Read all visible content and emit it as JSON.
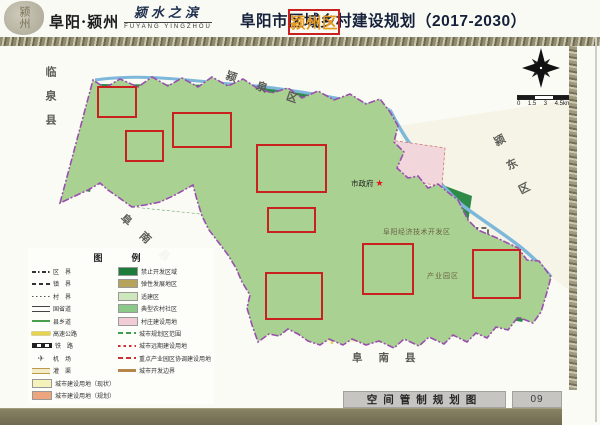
{
  "header": {
    "seal_text": "颍州",
    "brand": "阜阳·颍州",
    "slogan": "颍水之滨",
    "slogan_en": "FUYANG YINGZHOU",
    "title": {
      "prefix": "阜阳市",
      "highlight": "颍州区",
      "suffix": "区域乡村建设规划（2017-2030）"
    }
  },
  "colors": {
    "title_highlight": "#e8991c",
    "highlight_box": "#c92020",
    "district_boundary": "#9a4fae",
    "prohibited_green": "#1e7c3a",
    "suitable_green": "#a9d292",
    "flexible_olive": "#beab67",
    "village_pink": "#f2ccd6"
  },
  "map": {
    "region_labels": {
      "linquan": {
        "text": "临泉县"
      },
      "yingquan": {
        "text": "颍泉区"
      },
      "yingdong": {
        "text": "颍东区"
      },
      "funan_west": {
        "text": "阜南县"
      },
      "funan_south": {
        "text": "阜南县"
      }
    },
    "poi_labels": {
      "city_hall": {
        "text": "市政府",
        "marker": "★"
      },
      "dev_zone": {
        "text": "阜阳经济技术开发区"
      },
      "industry_park": {
        "text": "产业园区"
      }
    },
    "scale_bar": {
      "labels": [
        "0",
        "1.5",
        "3",
        "4.5km"
      ]
    }
  },
  "legend": {
    "title": "图　例",
    "left_items": [
      {
        "label": "区　界",
        "type": "district-boundary"
      },
      {
        "label": "镇　界",
        "type": "town-boundary"
      },
      {
        "label": "村　界",
        "type": "village-boundary"
      },
      {
        "label": "国省道",
        "type": "national-provincial-road"
      },
      {
        "label": "县乡道",
        "type": "county-road"
      },
      {
        "label": "高速公路",
        "type": "expressway"
      },
      {
        "label": "铁　路",
        "type": "railway"
      },
      {
        "label": "机　场",
        "type": "airport"
      },
      {
        "label": "灌　渠",
        "type": "canal"
      },
      {
        "label": "城市建设用地（现状）",
        "type": "urban-land-existing"
      },
      {
        "label": "城市建设用地（规划）",
        "type": "urban-land-planned"
      }
    ],
    "right_items": [
      {
        "label": "禁止开发区域",
        "type": "prohibited-development"
      },
      {
        "label": "弹性发展地区",
        "type": "flexible-development"
      },
      {
        "label": "适建区",
        "type": "suitable-construction"
      },
      {
        "label": "典型农村社区",
        "type": "typical-rural-community"
      },
      {
        "label": "村庄建设用地",
        "type": "village-construction-land"
      },
      {
        "label": "城市规划区范围",
        "type": "urban-planning-scope"
      },
      {
        "label": "城市远期建设用地",
        "type": "long-term-urban-land"
      },
      {
        "label": "重点产业园区协调建设用地",
        "type": "key-industry-park-land"
      },
      {
        "label": "城市开发边界",
        "type": "urban-growth-boundary"
      }
    ]
  },
  "footer": {
    "caption": "空间管制规划图",
    "page_number": "09"
  }
}
